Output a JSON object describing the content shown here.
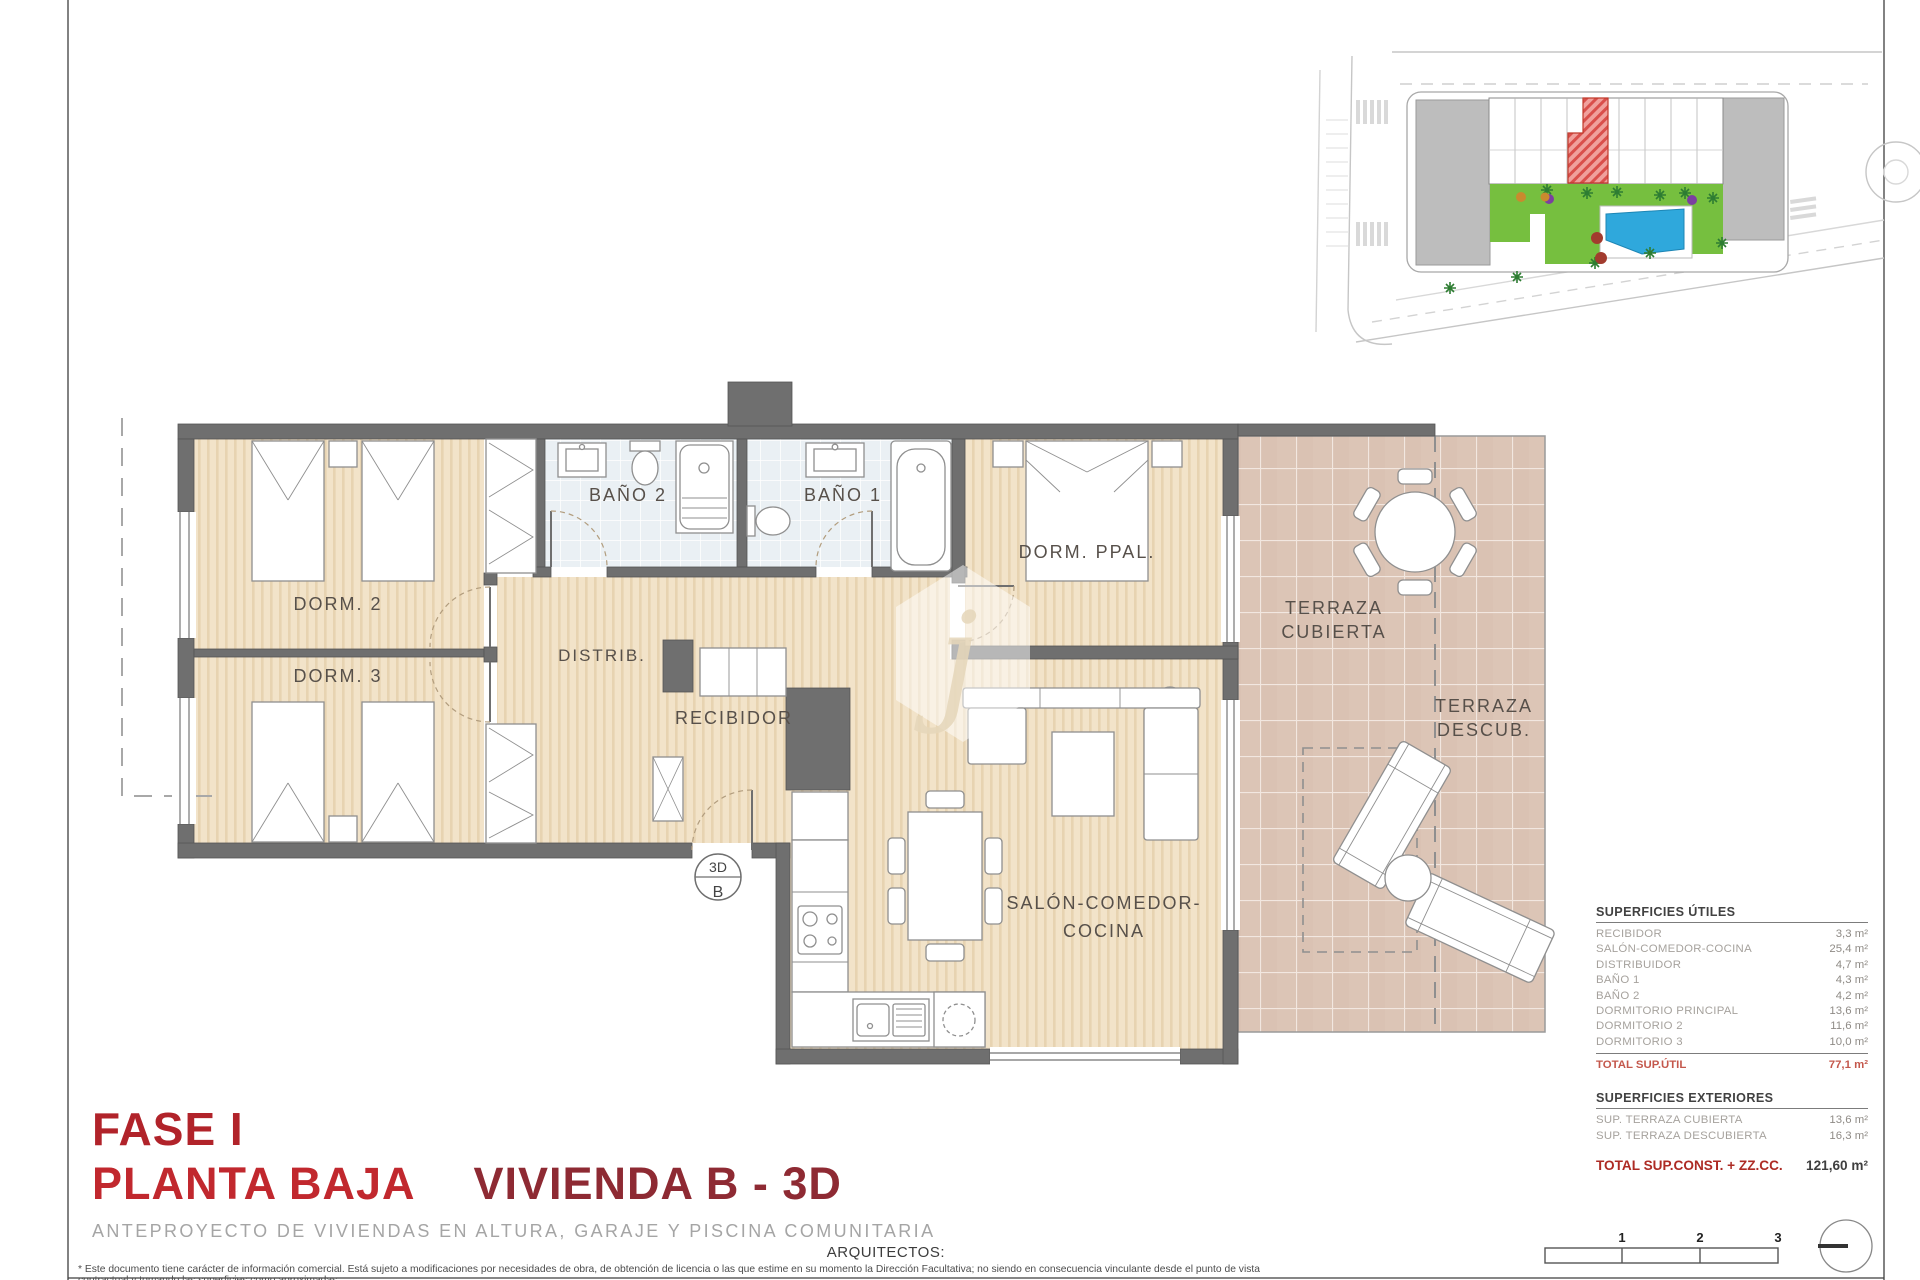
{
  "plan": {
    "rooms": {
      "dorm2": "DORM. 2",
      "dorm3": "DORM. 3",
      "bano2": "BAÑO 2",
      "bano1": "BAÑO 1",
      "dorm_ppal": "DORM. PPAL.",
      "distrib": "DISTRIB.",
      "recibidor": "RECIBIDOR",
      "salon": [
        "SALÓN-COMEDOR-",
        "COCINA"
      ],
      "terraza_cubierta": [
        "TERRAZA",
        "CUBIERTA"
      ],
      "terraza_descub": [
        "TERRAZA",
        "DESCUB."
      ]
    },
    "entrance_marker": {
      "line1": "3D",
      "line2": "B"
    }
  },
  "tables": {
    "utiles": {
      "title": "SUPERFICIES ÚTILES",
      "rows": [
        {
          "label": "RECIBIDOR",
          "value": "3,3 m²"
        },
        {
          "label": "SALÓN-COMEDOR-COCINA",
          "value": "25,4 m²"
        },
        {
          "label": "DISTRIBUIDOR",
          "value": "4,7 m²"
        },
        {
          "label": "BAÑO 1",
          "value": "4,3 m²"
        },
        {
          "label": "BAÑO 2",
          "value": "4,2 m²"
        },
        {
          "label": "DORMITORIO PRINCIPAL",
          "value": "13,6 m²"
        },
        {
          "label": "DORMITORIO 2",
          "value": "11,6 m²"
        },
        {
          "label": "DORMITORIO 3",
          "value": "10,0 m²"
        }
      ],
      "total_label": "TOTAL SUP.ÚTIL",
      "total_value": "77,1 m²"
    },
    "exteriores": {
      "title": "SUPERFICIES EXTERIORES",
      "rows": [
        {
          "label": "SUP. TERRAZA CUBIERTA",
          "value": "13,6 m²"
        },
        {
          "label": "SUP. TERRAZA DESCUBIERTA",
          "value": "16,3 m²"
        }
      ]
    },
    "total_const": {
      "label": "TOTAL SUP.CONST. + ZZ.CC.",
      "value": "121,60 m²"
    }
  },
  "titles": {
    "phase": "FASE I",
    "floor": "PLANTA BAJA",
    "unit": "VIVIENDA B - 3D",
    "subtitle": "ANTEPROYECTO DE VIVIENDAS EN ALTURA, GARAJE Y PISCINA COMUNITARIA",
    "architects": "ARQUITECTOS:"
  },
  "footer": {
    "disclaimer": "* Este documento tiene carácter de información comercial. Está sujeto a modificaciones por necesidades de obra, de obtención de licencia o las que estime en su momento la Dirección Facultativa; no siendo en consecuencia vinculante desde el punto de vista contractual y tomando las superficies como aproximadas,"
  },
  "scale_bar": {
    "ticks": [
      "1",
      "2",
      "3"
    ]
  },
  "colors": {
    "wall": "#6f6f6f",
    "wood_floor": "#f2e3c9",
    "bath_floor": "#eaf0f4",
    "terrace_floor": "#dcc5b6",
    "highlight_unit": "#d94f4b",
    "title_red": "#c1282e",
    "total_red": "#c4584c",
    "pool_blue": "#2fa8dc",
    "garden_green": "#76bf3f"
  }
}
